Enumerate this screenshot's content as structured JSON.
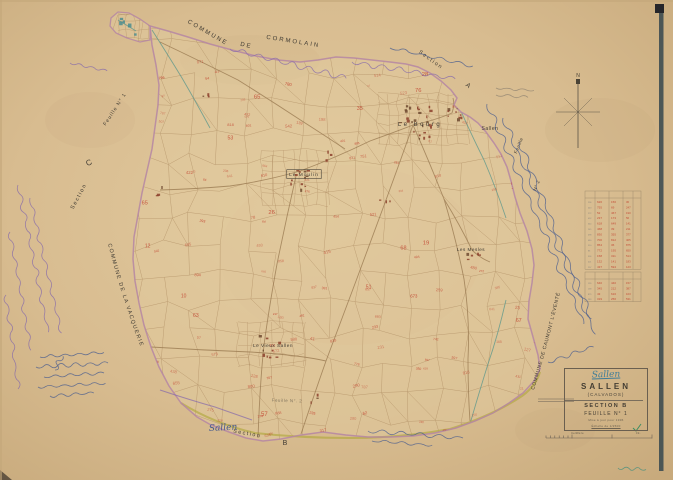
{
  "page": {
    "background": "#d7ba8e",
    "width": 673,
    "height": 480,
    "kind": "scanned cadastral map sheet"
  },
  "map": {
    "boundary_color": "#b586a3",
    "parcel_line_color": "#a9865c",
    "parcel_number_color": "#c03a28",
    "stream_color": "#5f988c",
    "road_color": "#97774e",
    "highlight_road_color": "#b3a943",
    "ink_blue": "#44598f",
    "ink_purple": "#8468ab",
    "pencil_gray": "#8d8270",
    "compass_label": "N",
    "neighbors": {
      "north": "COMMUNE DE CORMOLAIN",
      "west": "COMMUNE DE LA VACQUERIE",
      "east": "COMMUNE DE CAUMONT L'ÉVENTÉ"
    },
    "labels": [
      {
        "id": "commune-north-1",
        "text": "COMMUNE",
        "x": 207,
        "y": 34,
        "rot": 30,
        "size": 6,
        "ls": 2
      },
      {
        "id": "commune-north-2",
        "text": "DE",
        "x": 246,
        "y": 47,
        "rot": 13,
        "size": 6,
        "ls": 2
      },
      {
        "id": "commune-north-3",
        "text": "CORMOLAIN",
        "x": 293,
        "y": 43,
        "rot": 9,
        "size": 6,
        "ls": 2
      },
      {
        "id": "section-a-word",
        "text": "Section",
        "x": 430,
        "y": 61,
        "rot": 36,
        "size": 5.4,
        "ls": 1.5
      },
      {
        "id": "section-a-letter",
        "text": "A",
        "x": 467,
        "y": 87,
        "rot": 36,
        "size": 6.5,
        "ls": 0
      },
      {
        "id": "feuille-west",
        "text": "Feuille N° 1",
        "x": 116,
        "y": 110,
        "rot": -57,
        "size": 5,
        "ls": 1
      },
      {
        "id": "section-c-word",
        "text": "Section",
        "x": 80,
        "y": 197,
        "rot": -62,
        "size": 5.4,
        "ls": 1.5
      },
      {
        "id": "section-c-letter",
        "text": "C",
        "x": 90,
        "y": 165,
        "rot": -25,
        "size": 8,
        "ls": 0
      },
      {
        "id": "place-le-bourg",
        "text": "Le Bourg",
        "x": 420,
        "y": 126,
        "rot": 0,
        "size": 6,
        "ls": 2.5
      },
      {
        "id": "place-le-moulin",
        "text": "Le Moulin",
        "x": 304,
        "y": 176,
        "rot": 0,
        "size": 4.8,
        "ls": 1,
        "boxed": true
      },
      {
        "id": "place-les-mesles",
        "text": "Les Mesles",
        "x": 471,
        "y": 251,
        "rot": 0,
        "size": 4.6,
        "ls": 0.5
      },
      {
        "id": "place-le-vieux-sallen",
        "text": "Le Vieux Sallen",
        "x": 273,
        "y": 347,
        "rot": 0,
        "size": 4.7,
        "ls": 0.5
      },
      {
        "id": "ref-sallen-east",
        "text": "Sallen",
        "x": 490,
        "y": 130,
        "rot": 0,
        "size": 5,
        "ls": 0.5
      },
      {
        "id": "feuille-east",
        "text": "Feuille",
        "x": 520,
        "y": 146,
        "rot": -68,
        "size": 4.6,
        "ls": 0.5
      },
      {
        "id": "feuille-east-num",
        "text": "N° 2",
        "x": 538,
        "y": 186,
        "rot": -68,
        "size": 4.6,
        "ls": 0.5
      },
      {
        "id": "section-b-word",
        "text": "Section",
        "x": 247,
        "y": 435,
        "rot": 10,
        "size": 5.4,
        "ls": 1.5
      },
      {
        "id": "section-b-letter",
        "text": "B",
        "x": 285,
        "y": 445,
        "rot": 0,
        "size": 7,
        "ls": 0
      },
      {
        "id": "feuille-south",
        "text": "Feuille N°. 2",
        "x": 287,
        "y": 402,
        "rot": 2,
        "size": 4.4,
        "ls": 0.5,
        "faint": true
      }
    ],
    "curved_labels": [
      {
        "id": "commune-west",
        "text": "COMMUNE   DE   LA   VACQUERIE",
        "path": "M 108,244 Q 130,330 163,398",
        "size": 5.4,
        "ls": 1.3
      },
      {
        "id": "commune-east",
        "text": "COMMUNE  DE  CAUMONT L'ÉVENTÉ",
        "path": "M 534,390 Q 556,318 570,244",
        "size": 4.9,
        "ls": 0.6
      }
    ],
    "handwritten_labels": [
      {
        "id": "sallen-handwritten-south",
        "text": "Sallen",
        "x": 209,
        "y": 431,
        "rot": -3,
        "size": 9,
        "color": "#44598f"
      }
    ]
  },
  "title_block": {
    "handwritten_name": "Sallen",
    "commune_name": "SALLEN",
    "department": "(CALVADOS)",
    "section_line": "SECTION B",
    "sheet_line": "FEUILLE N° 1",
    "notes": [
      "Mise à jour pour 1936",
      "Échelle de 1/2500"
    ],
    "footer_left": "Certifié le",
    "footer_right": "19.."
  },
  "marginalia": {
    "legend_table": {
      "rows": 14,
      "extra_rows": 4,
      "columns": 4,
      "ink_color": "#c03a28"
    },
    "check_mark_color": "#3e8e62"
  }
}
